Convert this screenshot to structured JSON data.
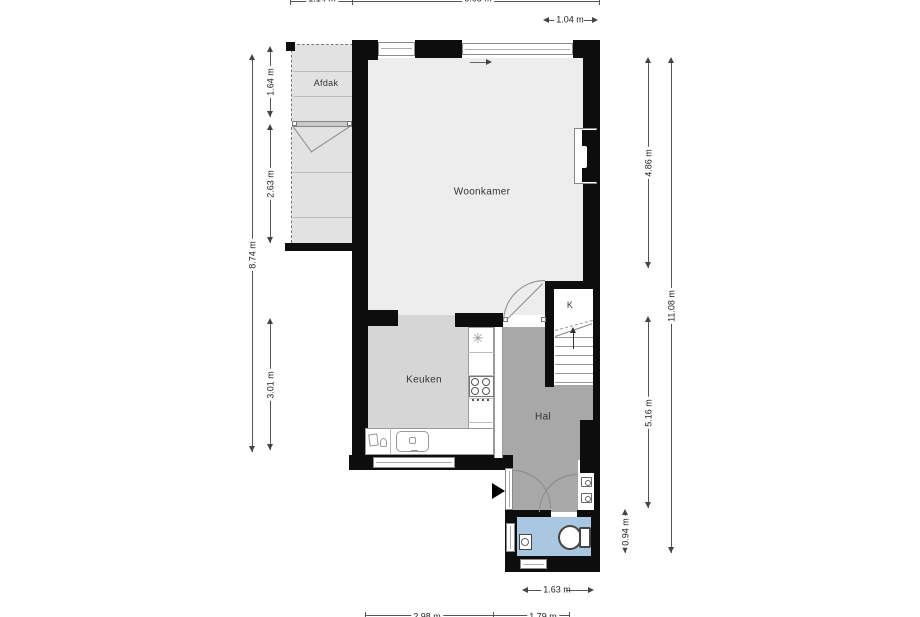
{
  "plan_title": "floor-plan",
  "rooms": {
    "living": "Woonkamer",
    "kitchen": "Keuken",
    "hall": "Hal",
    "closet": "K",
    "canopy": "Afdak"
  },
  "dimensions": {
    "top_left": "1.14 m",
    "top_main": "6.08 m",
    "top_right": "1.04 m",
    "left_outer": "8.74 m",
    "left_canopy": "1.64 m",
    "left_storage": "2.63 m",
    "left_kitchen": "3.01 m",
    "right_top": "4.86 m",
    "right_bottom": "5.16 m",
    "right_outer": "11.08 m",
    "right_wc": "0.94 m",
    "bottom_wc": "1.63 m",
    "bottom_left": "2.98 m",
    "bottom_right": "1.79 m"
  },
  "icons": {
    "vent": "✳"
  },
  "colors": {
    "wall": "#0d0d0d",
    "floor_living": "#ededed",
    "floor_kitchen": "#d6d6d6",
    "floor_hall": "#a8a8a8",
    "floor_wc": "#a9c7e1",
    "floor_canopy": "#e2e2e2",
    "floor_closet": "#ffffff"
  }
}
